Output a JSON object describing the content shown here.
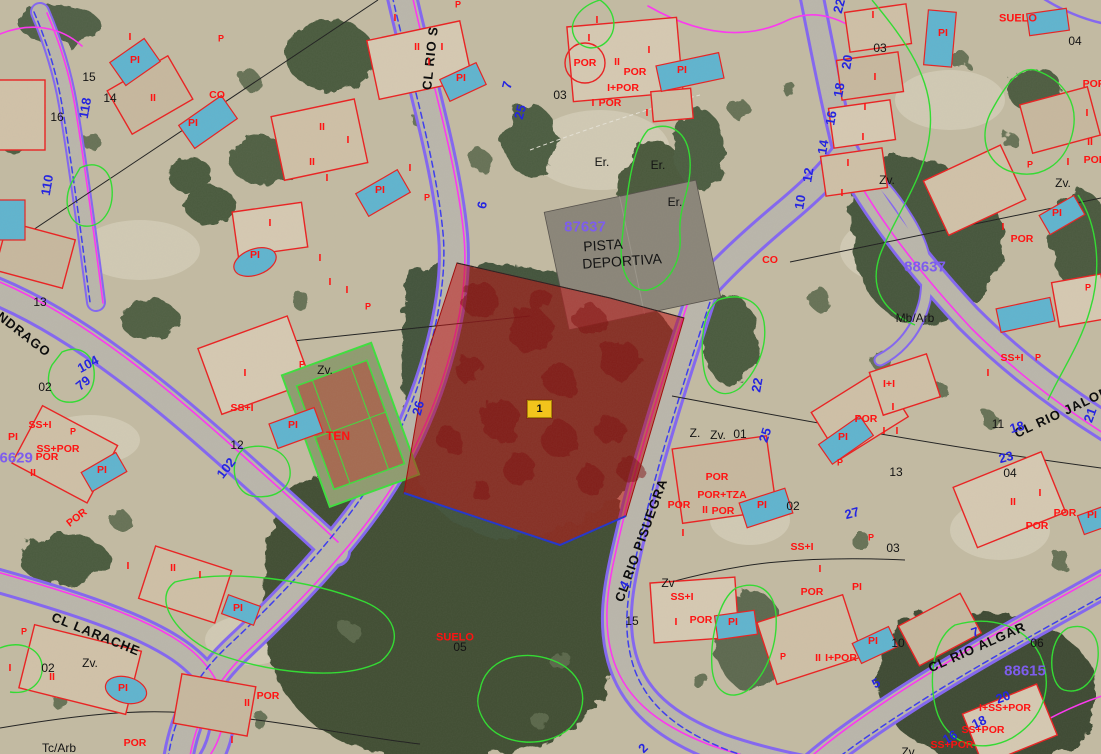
{
  "map": {
    "marker": {
      "label": "1",
      "x": 527,
      "y": 400
    },
    "highlight": {
      "fill": "#c01212",
      "opacity": 0.55
    },
    "colors": {
      "cadastre_red": "#ff1212",
      "number_blue": "#2525e0",
      "block_purple": "#7d5ded",
      "road_purple": "#8365f2",
      "road_magenta": "#ff35f2",
      "contour_green": "#2fdd2f",
      "marker_yellow": "#f2c41c"
    },
    "labels": {
      "streets": [
        {
          "t": "CL RIO S",
          "x": 430,
          "y": 58,
          "r": -84
        },
        {
          "t": "CL RIO PISUEGRA",
          "x": 641,
          "y": 540,
          "r": -70
        },
        {
          "t": "CL RIO JALON",
          "x": 1062,
          "y": 412,
          "r": -25
        },
        {
          "t": "CL RIO ALGAR",
          "x": 977,
          "y": 647,
          "r": -24
        },
        {
          "t": "ANDRAGO",
          "x": 20,
          "y": 331,
          "r": 38
        },
        {
          "t": "CL LARACHE",
          "x": 96,
          "y": 634,
          "r": 22
        }
      ],
      "blocks": [
        {
          "t": "87637",
          "x": 585,
          "y": 227
        },
        {
          "t": "88637",
          "x": 925,
          "y": 267
        },
        {
          "t": "88615",
          "x": 1025,
          "y": 671
        },
        {
          "t": "86629",
          "x": 12,
          "y": 458
        }
      ],
      "house_numbers": [
        {
          "t": "118",
          "x": 85,
          "y": 108,
          "r": -80
        },
        {
          "t": "110",
          "x": 47,
          "y": 185,
          "r": -80
        },
        {
          "t": "104",
          "x": 88,
          "y": 364,
          "r": -28
        },
        {
          "t": "79",
          "x": 83,
          "y": 383,
          "r": -38
        },
        {
          "t": "102",
          "x": 226,
          "y": 468,
          "r": -52
        },
        {
          "t": "7",
          "x": 507,
          "y": 85,
          "r": -75
        },
        {
          "t": "25",
          "x": 520,
          "y": 112,
          "r": -75
        },
        {
          "t": "6",
          "x": 482,
          "y": 205,
          "r": -78
        },
        {
          "t": "26",
          "x": 418,
          "y": 408,
          "r": -75
        },
        {
          "t": "22",
          "x": 757,
          "y": 385,
          "r": -80
        },
        {
          "t": "25",
          "x": 765,
          "y": 435,
          "r": -72
        },
        {
          "t": "27",
          "x": 852,
          "y": 513,
          "r": -15
        },
        {
          "t": "4",
          "x": 624,
          "y": 585,
          "r": -60
        },
        {
          "t": "2",
          "x": 643,
          "y": 748,
          "r": -45
        },
        {
          "t": "22",
          "x": 839,
          "y": 6,
          "r": -75
        },
        {
          "t": "20",
          "x": 847,
          "y": 62,
          "r": -80
        },
        {
          "t": "18",
          "x": 839,
          "y": 90,
          "r": -80
        },
        {
          "t": "16",
          "x": 831,
          "y": 118,
          "r": -80
        },
        {
          "t": "14",
          "x": 823,
          "y": 147,
          "r": -80
        },
        {
          "t": "12",
          "x": 808,
          "y": 175,
          "r": -80
        },
        {
          "t": "10",
          "x": 800,
          "y": 202,
          "r": -80
        },
        {
          "t": "18",
          "x": 1017,
          "y": 427,
          "r": -15
        },
        {
          "t": "21",
          "x": 1090,
          "y": 415,
          "r": -70
        },
        {
          "t": "23",
          "x": 1006,
          "y": 457,
          "r": -15
        },
        {
          "t": "7",
          "x": 975,
          "y": 632,
          "r": -20
        },
        {
          "t": "5",
          "x": 876,
          "y": 683,
          "r": -30
        },
        {
          "t": "20",
          "x": 1003,
          "y": 697,
          "r": -20
        },
        {
          "t": "18",
          "x": 979,
          "y": 722,
          "r": -25
        },
        {
          "t": "16",
          "x": 950,
          "y": 737,
          "r": -30
        }
      ],
      "parcels": [
        {
          "t": "15",
          "x": 89,
          "y": 77
        },
        {
          "t": "14",
          "x": 110,
          "y": 98
        },
        {
          "t": "16",
          "x": 57,
          "y": 117
        },
        {
          "t": "13",
          "x": 40,
          "y": 302
        },
        {
          "t": "02",
          "x": 45,
          "y": 387
        },
        {
          "t": "12",
          "x": 237,
          "y": 445
        },
        {
          "t": "02",
          "x": 48,
          "y": 668
        },
        {
          "t": "Tc/Arb",
          "x": 59,
          "y": 748
        },
        {
          "t": "Zv.",
          "x": 90,
          "y": 663
        },
        {
          "t": "Zv.",
          "x": 325,
          "y": 370
        },
        {
          "t": "03",
          "x": 560,
          "y": 95
        },
        {
          "t": "Er.",
          "x": 602,
          "y": 162
        },
        {
          "t": "Er.",
          "x": 658,
          "y": 165
        },
        {
          "t": "Er.",
          "x": 675,
          "y": 202
        },
        {
          "t": "03",
          "x": 880,
          "y": 48
        },
        {
          "t": "04",
          "x": 1075,
          "y": 41
        },
        {
          "t": "Zv.",
          "x": 887,
          "y": 180
        },
        {
          "t": "Zv.",
          "x": 1063,
          "y": 183
        },
        {
          "t": "Mb/Arb",
          "x": 915,
          "y": 318
        },
        {
          "t": "11",
          "x": 998,
          "y": 424
        },
        {
          "t": "04",
          "x": 1010,
          "y": 473
        },
        {
          "t": "Z.",
          "x": 695,
          "y": 433
        },
        {
          "t": "Zv.",
          "x": 718,
          "y": 435
        },
        {
          "t": "01",
          "x": 740,
          "y": 434
        },
        {
          "t": "02",
          "x": 793,
          "y": 506
        },
        {
          "t": "03",
          "x": 893,
          "y": 548
        },
        {
          "t": "13",
          "x": 896,
          "y": 472
        },
        {
          "t": "05",
          "x": 460,
          "y": 647
        },
        {
          "t": "15",
          "x": 632,
          "y": 621
        },
        {
          "t": "Zv",
          "x": 668,
          "y": 583
        },
        {
          "t": "10",
          "x": 898,
          "y": 643
        },
        {
          "t": "06",
          "x": 1037,
          "y": 643
        },
        {
          "t": "Zv",
          "x": 908,
          "y": 752
        },
        {
          "t": "PISTA",
          "x": 603,
          "y": 245,
          "r": -4,
          "s": 14
        },
        {
          "t": "DEPORTIVA",
          "x": 622,
          "y": 261,
          "r": -4,
          "s": 14
        }
      ],
      "codes": [
        {
          "t": "PI",
          "x": 135,
          "y": 60
        },
        {
          "t": "I",
          "x": 130,
          "y": 37
        },
        {
          "t": "P",
          "x": 221,
          "y": 39,
          "s": 9
        },
        {
          "t": "II",
          "x": 153,
          "y": 98
        },
        {
          "t": "CO",
          "x": 217,
          "y": 95
        },
        {
          "t": "PI",
          "x": 193,
          "y": 123
        },
        {
          "t": "II",
          "x": 322,
          "y": 127
        },
        {
          "t": "II",
          "x": 312,
          "y": 162
        },
        {
          "t": "I",
          "x": 327,
          "y": 178
        },
        {
          "t": "I",
          "x": 348,
          "y": 140
        },
        {
          "t": "I",
          "x": 410,
          "y": 168
        },
        {
          "t": "PI",
          "x": 380,
          "y": 190
        },
        {
          "t": "P",
          "x": 427,
          "y": 198,
          "s": 9
        },
        {
          "t": "I",
          "x": 270,
          "y": 223
        },
        {
          "t": "PI",
          "x": 255,
          "y": 255
        },
        {
          "t": "I",
          "x": 320,
          "y": 258
        },
        {
          "t": "I",
          "x": 330,
          "y": 282
        },
        {
          "t": "I",
          "x": 347,
          "y": 290
        },
        {
          "t": "P",
          "x": 368,
          "y": 307,
          "s": 9
        },
        {
          "t": "I",
          "x": 245,
          "y": 373
        },
        {
          "t": "SS+I",
          "x": 242,
          "y": 408
        },
        {
          "t": "PI",
          "x": 293,
          "y": 425
        },
        {
          "t": "TEN",
          "x": 338,
          "y": 436,
          "s": 12
        },
        {
          "t": "P",
          "x": 302,
          "y": 365,
          "s": 9
        },
        {
          "t": "SS+I",
          "x": 40,
          "y": 425
        },
        {
          "t": "SS+POR",
          "x": 58,
          "y": 449
        },
        {
          "t": "POR",
          "x": 47,
          "y": 457
        },
        {
          "t": "II",
          "x": 33,
          "y": 473
        },
        {
          "t": "PI",
          "x": 102,
          "y": 470
        },
        {
          "t": "P",
          "x": 73,
          "y": 432,
          "s": 9
        },
        {
          "t": "PI",
          "x": 13,
          "y": 437
        },
        {
          "t": "POR",
          "x": 77,
          "y": 518,
          "r": -38
        },
        {
          "t": "I",
          "x": 10,
          "y": 668
        },
        {
          "t": "II",
          "x": 52,
          "y": 677
        },
        {
          "t": "PI",
          "x": 123,
          "y": 688
        },
        {
          "t": "P",
          "x": 24,
          "y": 632,
          "s": 9
        },
        {
          "t": "POR",
          "x": 135,
          "y": 743
        },
        {
          "t": "I",
          "x": 128,
          "y": 566
        },
        {
          "t": "II",
          "x": 173,
          "y": 568
        },
        {
          "t": "I",
          "x": 200,
          "y": 575
        },
        {
          "t": "PI",
          "x": 238,
          "y": 608
        },
        {
          "t": "POR",
          "x": 268,
          "y": 696
        },
        {
          "t": "II",
          "x": 247,
          "y": 703
        },
        {
          "t": "I",
          "x": 232,
          "y": 740
        },
        {
          "t": "I",
          "x": 395,
          "y": 18
        },
        {
          "t": "II",
          "x": 417,
          "y": 47
        },
        {
          "t": "I",
          "x": 442,
          "y": 47
        },
        {
          "t": "I",
          "x": 429,
          "y": 62
        },
        {
          "t": "PI",
          "x": 461,
          "y": 78
        },
        {
          "t": "P",
          "x": 458,
          "y": 5,
          "s": 9
        },
        {
          "t": "I",
          "x": 597,
          "y": 20
        },
        {
          "t": "POR",
          "x": 585,
          "y": 63
        },
        {
          "t": "II",
          "x": 617,
          "y": 62
        },
        {
          "t": "POR",
          "x": 635,
          "y": 72
        },
        {
          "t": "I+POR",
          "x": 623,
          "y": 88
        },
        {
          "t": "POR",
          "x": 610,
          "y": 103
        },
        {
          "t": "I",
          "x": 589,
          "y": 38
        },
        {
          "t": "I",
          "x": 649,
          "y": 50
        },
        {
          "t": "I",
          "x": 593,
          "y": 103
        },
        {
          "t": "I",
          "x": 647,
          "y": 113
        },
        {
          "t": "PI",
          "x": 682,
          "y": 70
        },
        {
          "t": "CO",
          "x": 770,
          "y": 260
        },
        {
          "t": "SUELO",
          "x": 1018,
          "y": 19,
          "s": 11
        },
        {
          "t": "PI",
          "x": 943,
          "y": 33
        },
        {
          "t": "I",
          "x": 873,
          "y": 15
        },
        {
          "t": "I",
          "x": 875,
          "y": 77
        },
        {
          "t": "I",
          "x": 865,
          "y": 107
        },
        {
          "t": "I",
          "x": 863,
          "y": 137
        },
        {
          "t": "I",
          "x": 848,
          "y": 163
        },
        {
          "t": "I",
          "x": 842,
          "y": 193
        },
        {
          "t": "POR",
          "x": 1094,
          "y": 84
        },
        {
          "t": "I",
          "x": 1087,
          "y": 113
        },
        {
          "t": "II",
          "x": 1090,
          "y": 142
        },
        {
          "t": "I",
          "x": 1068,
          "y": 162
        },
        {
          "t": "POR",
          "x": 1095,
          "y": 160
        },
        {
          "t": "P",
          "x": 1030,
          "y": 165,
          "s": 9
        },
        {
          "t": "PI",
          "x": 1057,
          "y": 213
        },
        {
          "t": "I",
          "x": 1003,
          "y": 227
        },
        {
          "t": "POR",
          "x": 1022,
          "y": 239
        },
        {
          "t": "P",
          "x": 1088,
          "y": 288,
          "s": 9
        },
        {
          "t": "SS+I",
          "x": 1012,
          "y": 358
        },
        {
          "t": "I",
          "x": 988,
          "y": 373
        },
        {
          "t": "P",
          "x": 1038,
          "y": 358,
          "s": 9
        },
        {
          "t": "I+I",
          "x": 889,
          "y": 384
        },
        {
          "t": "I",
          "x": 893,
          "y": 407
        },
        {
          "t": "POR",
          "x": 866,
          "y": 419
        },
        {
          "t": "I",
          "x": 884,
          "y": 431
        },
        {
          "t": "I",
          "x": 897,
          "y": 431
        },
        {
          "t": "PI",
          "x": 843,
          "y": 437
        },
        {
          "t": "P",
          "x": 840,
          "y": 463,
          "s": 9
        },
        {
          "t": "POR",
          "x": 717,
          "y": 477
        },
        {
          "t": "POR+TZA",
          "x": 722,
          "y": 495
        },
        {
          "t": "POR",
          "x": 679,
          "y": 505
        },
        {
          "t": "II",
          "x": 705,
          "y": 510
        },
        {
          "t": "POR",
          "x": 723,
          "y": 511
        },
        {
          "t": "PI",
          "x": 762,
          "y": 505
        },
        {
          "t": "I",
          "x": 683,
          "y": 533
        },
        {
          "t": "SS+I",
          "x": 802,
          "y": 547
        },
        {
          "t": "P",
          "x": 871,
          "y": 538,
          "s": 9
        },
        {
          "t": "II",
          "x": 1013,
          "y": 502
        },
        {
          "t": "I",
          "x": 1040,
          "y": 493
        },
        {
          "t": "POR",
          "x": 1065,
          "y": 513
        },
        {
          "t": "POR",
          "x": 1037,
          "y": 526
        },
        {
          "t": "PI",
          "x": 1092,
          "y": 515
        },
        {
          "t": "SS+I",
          "x": 682,
          "y": 597
        },
        {
          "t": "POR",
          "x": 701,
          "y": 620
        },
        {
          "t": "I",
          "x": 676,
          "y": 622
        },
        {
          "t": "PI",
          "x": 733,
          "y": 622
        },
        {
          "t": "POR",
          "x": 812,
          "y": 592
        },
        {
          "t": "I",
          "x": 820,
          "y": 569
        },
        {
          "t": "PI",
          "x": 857,
          "y": 587
        },
        {
          "t": "II",
          "x": 818,
          "y": 658
        },
        {
          "t": "I+POR",
          "x": 841,
          "y": 658
        },
        {
          "t": "P",
          "x": 783,
          "y": 657,
          "s": 9
        },
        {
          "t": "PI",
          "x": 873,
          "y": 641
        },
        {
          "t": "I+SS+POR",
          "x": 1005,
          "y": 708
        },
        {
          "t": "SS+POR",
          "x": 983,
          "y": 730
        },
        {
          "t": "SS+POR",
          "x": 952,
          "y": 745
        },
        {
          "t": "SUELO",
          "x": 455,
          "y": 638,
          "s": 11
        }
      ]
    }
  }
}
